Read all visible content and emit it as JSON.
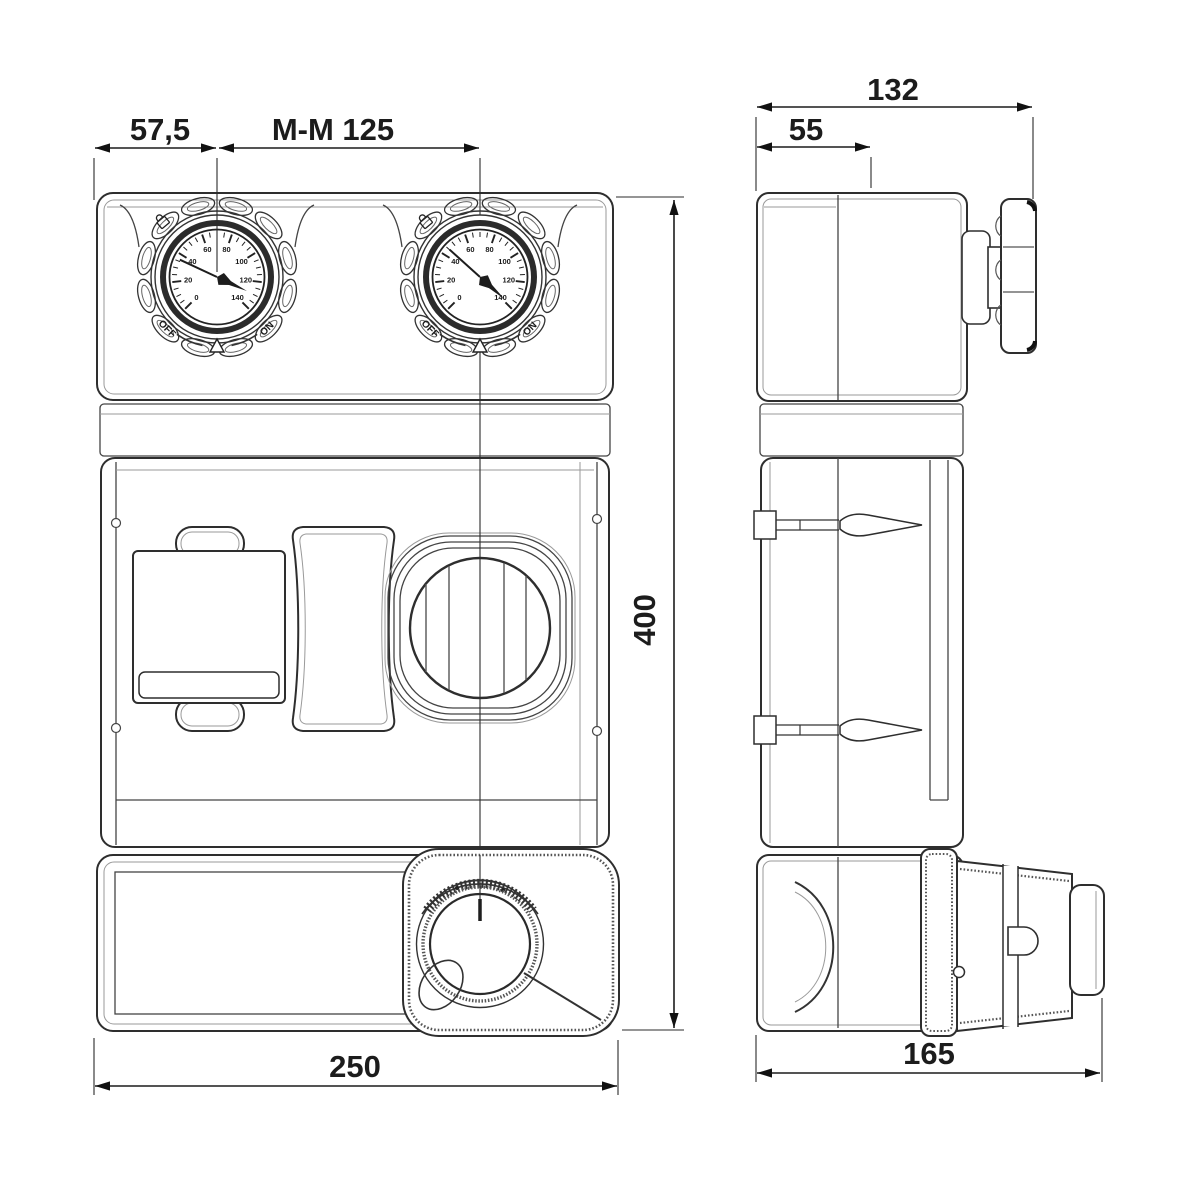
{
  "dimensions": {
    "offset": "57,5",
    "port_spacing": "M-M 125",
    "depth_total": "132",
    "depth_partial": "55",
    "height_total": "400",
    "width_front": "250",
    "depth_side": "165"
  },
  "gauges": {
    "off": "OFF",
    "on": "ON",
    "dial_numbers": [
      "0",
      "20",
      "40",
      "60",
      "80",
      "100",
      "120",
      "140"
    ]
  },
  "colors": {
    "line": "#333333",
    "dim": "#1c1c1c",
    "light": "#9a9a9a",
    "background": "#ffffff"
  }
}
